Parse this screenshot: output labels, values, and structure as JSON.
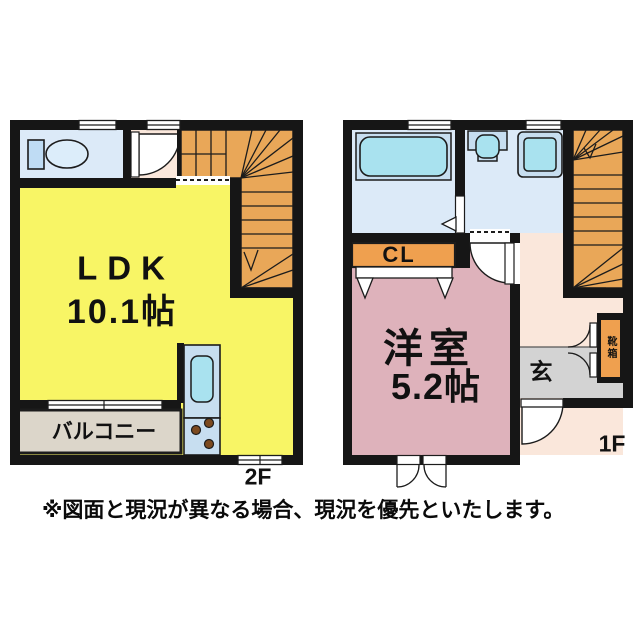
{
  "floor2": {
    "floor_label": "2F",
    "ldk_name": "LDK",
    "ldk_size": "10.1帖",
    "balcony_label": "バルコニー"
  },
  "floor1": {
    "floor_label": "1F",
    "room_name": "洋室",
    "room_size": "5.2帖",
    "closet_label": "CL",
    "entrance_label": "玄",
    "shoebox_label": "靴箱"
  },
  "disclaimer": "※図面と現況が異なる場合、現況を優先といたします。",
  "colors": {
    "wall": "#161616",
    "ldk_yellow": "#F8F565",
    "stairs_orange": "#E9A758",
    "storage_orange": "#EFA04F",
    "room_pink": "#DEB2BB",
    "hall_beige": "#FAE7DB",
    "wet_room_blue": "#DCEAF8",
    "fixture_blue": "#C7DEF0",
    "fixture_cyan": "#A9E2EF",
    "entrance_gray": "#D3D3D3",
    "balcony_beige": "#DCD6CA",
    "burner_brown": "#7C4A1F"
  }
}
